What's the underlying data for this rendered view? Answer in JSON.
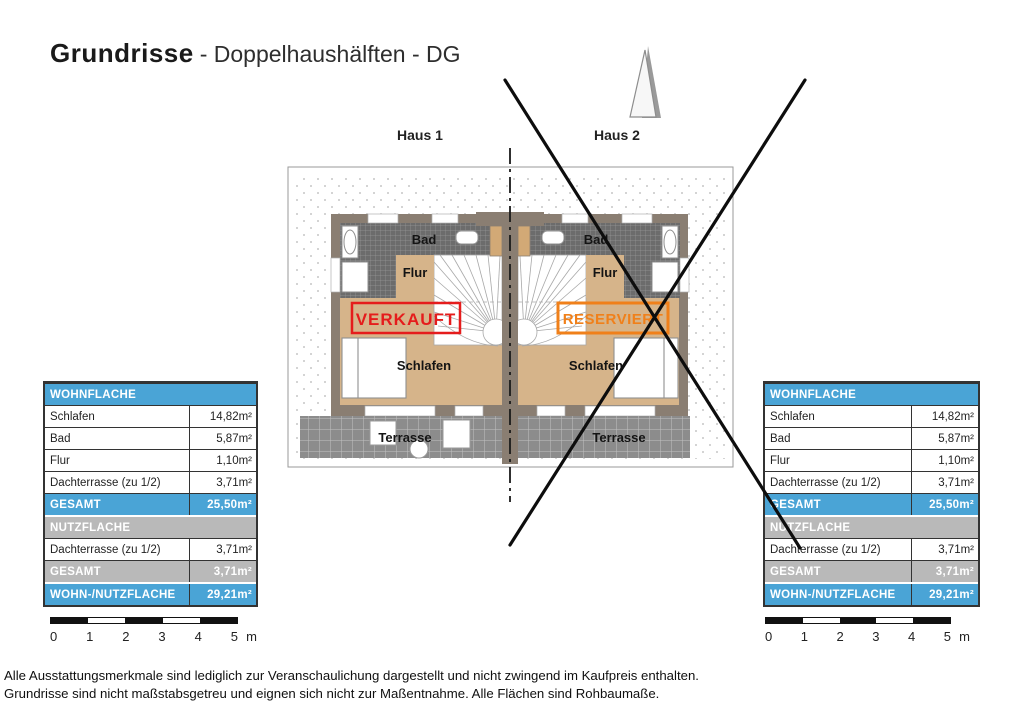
{
  "title": {
    "main": "Grundrisse",
    "rest": "- Doppelhaushälften - DG"
  },
  "plan": {
    "house1_label": "Haus 1",
    "house2_label": "Haus 2",
    "rooms": {
      "bad": "Bad",
      "flur": "Flur",
      "schlafen": "Schlafen",
      "terrasse": "Terrasse"
    },
    "status": {
      "left": "VERKAUFT",
      "right": "RESERVIERT"
    },
    "icons": {
      "north_arrow": "north-arrow-icon"
    }
  },
  "table": {
    "rows": [
      {
        "type": "header-blue",
        "label": "WOHNFLÄCHE",
        "value": ""
      },
      {
        "type": "row",
        "label": "Schlafen",
        "value": "14,82m²"
      },
      {
        "type": "row",
        "label": "Bad",
        "value": "5,87m²"
      },
      {
        "type": "row",
        "label": "Flur",
        "value": "1,10m²"
      },
      {
        "type": "row",
        "label": "Dachterrasse (zu 1/2)",
        "value": "3,71m²"
      },
      {
        "type": "total-blue",
        "label": "GESAMT",
        "value": "25,50m²"
      },
      {
        "type": "header-gray",
        "label": "NUTZFLÄCHE",
        "value": ""
      },
      {
        "type": "row",
        "label": "Dachterrasse (zu 1/2)",
        "value": "3,71m²"
      },
      {
        "type": "total-gray",
        "label": "GESAMT",
        "value": "3,71m²"
      },
      {
        "type": "grand-total",
        "label": "WOHN-/NUTZFLÄCHE",
        "value": "29,21m²"
      }
    ]
  },
  "scalebar": {
    "ticks": [
      "0",
      "1",
      "2",
      "3",
      "4",
      "5"
    ],
    "unit": "m"
  },
  "footer": {
    "line1": "Alle Ausstattungsmerkmale sind lediglich zur Veranschaulichung dargestellt und nicht zwingend im Kaufpreis enthalten.",
    "line2": "Grundrisse sind nicht maßstabsgetreu und eignen sich nicht zur Maßentnahme. Alle Flächen sind Rohbaumaße."
  },
  "colors": {
    "accent_blue": "#4aa4d6",
    "header_gray": "#b9b9b9",
    "sold_red": "#e51c1c",
    "reserved_orange": "#f0801a",
    "wall": "#8a7e72",
    "floor_tan": "#d6b48a",
    "bath_tile": "#6c6c6c",
    "terrace_tile": "#8c8c8c"
  }
}
